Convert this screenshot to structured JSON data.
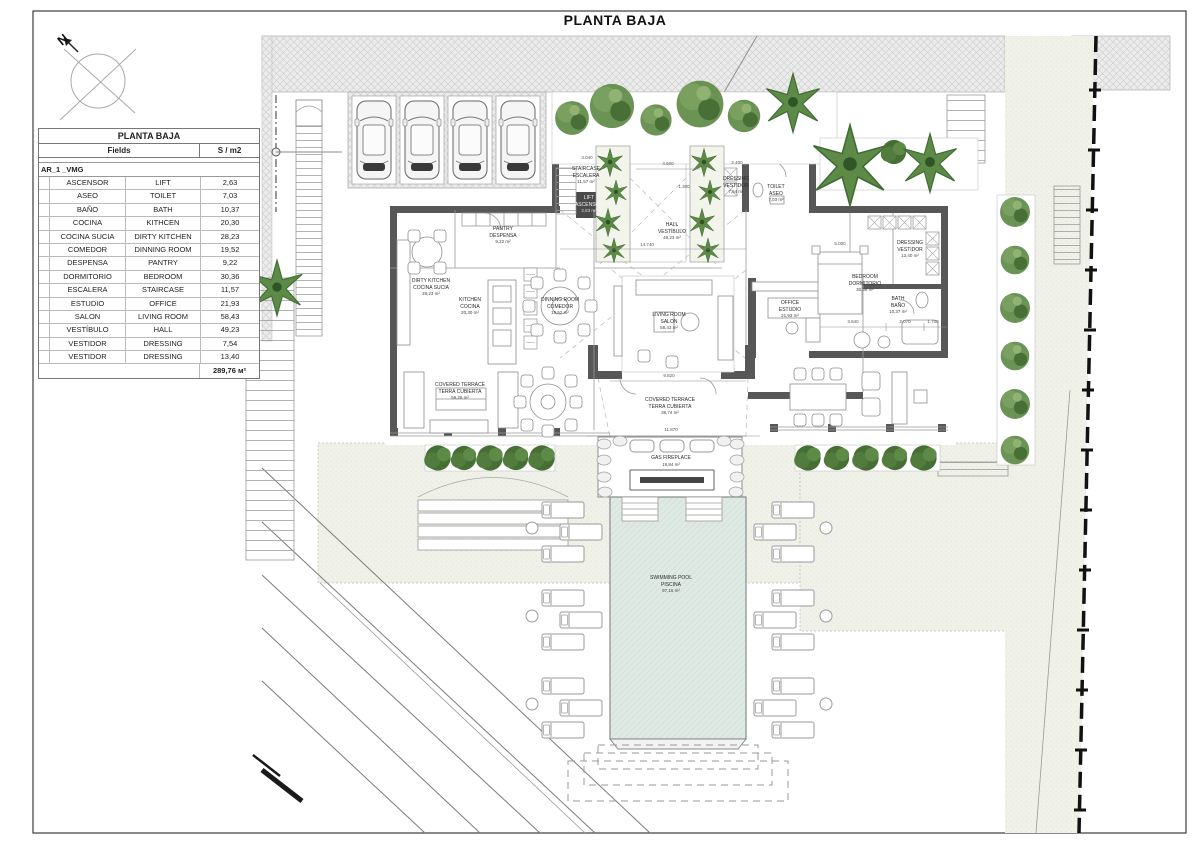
{
  "title": "PLANTA BAJA",
  "compass": {
    "north_label": "N"
  },
  "table": {
    "title": "PLANTA BAJA",
    "col_fields": "Fields",
    "col_area": "S / m2",
    "group": "AR_1 _VMG",
    "rows": [
      {
        "es": "ASCENSOR",
        "en": "LIFT",
        "area": "2,63"
      },
      {
        "es": "ASEO",
        "en": "TOILET",
        "area": "7,03"
      },
      {
        "es": "BAÑO",
        "en": "BATH",
        "area": "10,37"
      },
      {
        "es": "COCINA",
        "en": "KITHCEN",
        "area": "20,30"
      },
      {
        "es": "COCINA SUCIA",
        "en": "DIRTY KITCHEN",
        "area": "28,23"
      },
      {
        "es": "COMEDOR",
        "en": "DINNING ROOM",
        "area": "19,52"
      },
      {
        "es": "DESPENSA",
        "en": "PANTRY",
        "area": "9,22"
      },
      {
        "es": "DORMITORIO",
        "en": "BEDROOM",
        "area": "30,36"
      },
      {
        "es": "ESCALERA",
        "en": "STAIRCASE",
        "area": "11,57"
      },
      {
        "es": "ESTUDIO",
        "en": "OFFICE",
        "area": "21,93"
      },
      {
        "es": "SALON",
        "en": "LIVING ROOM",
        "area": "58,43"
      },
      {
        "es": "VESTÍBULO",
        "en": "HALL",
        "area": "49,23"
      },
      {
        "es": "VESTIDOR",
        "en": "DRESSING",
        "area": "7,54"
      },
      {
        "es": "VESTIDOR",
        "en": "DRESSING",
        "area": "13,40"
      }
    ],
    "total": "289,76 м²"
  },
  "plan": {
    "labels": {
      "pantry": {
        "en": "PANTRY",
        "es": "DESPENSA",
        "area": "9,22 m²"
      },
      "dirty_kitchen": {
        "en": "DIRTY KITCHEN",
        "es": "COCINA SUCIA",
        "area": "28,23 m²"
      },
      "kitchen": {
        "en": "KITCHEN",
        "es": "COCINA",
        "area": "20,30 m²"
      },
      "dining": {
        "en": "DINNING ROOM",
        "es": "COMEDOR",
        "area": "19,52 m²"
      },
      "living": {
        "en": "LIVING ROOM",
        "es": "SALON",
        "area": "58,43 m²"
      },
      "hall": {
        "en": "HALL",
        "es": "VESTÍBULO",
        "area": "49,23 m²"
      },
      "staircase": {
        "en": "STAIRCASE",
        "es": "ESCALERA",
        "area": "11,57 m²"
      },
      "lift": {
        "en": "LIFT",
        "es": "ASCENSOR",
        "area": "2,63 m²"
      },
      "dressing1": {
        "en": "DRESSING",
        "es": "VESTIDOR",
        "area": "7,54 m²"
      },
      "toilet": {
        "en": "TOILET",
        "es": "ASEO",
        "area": "7,03 m²"
      },
      "office": {
        "en": "OFFICE",
        "es": "ESTUDIO",
        "area": "21,93 m²"
      },
      "bedroom": {
        "en": "BEDROOM",
        "es": "DORMITORIO",
        "area": "30,36 m²"
      },
      "dressing2": {
        "en": "DRESSING",
        "es": "VESTIDOR",
        "area": "13,40 m²"
      },
      "bath": {
        "en": "BATH",
        "es": "BAÑO",
        "area": "10,37 m²"
      },
      "terrace_left": {
        "en": "COVERED TERRACE",
        "es": "TERRA CUBIERTA",
        "area": "59,26 m²"
      },
      "terrace_center": {
        "en": "COVERED TERRACE",
        "es": "TERRA CUBIERTA",
        "area": "38,74 m²"
      },
      "gas_fireplace": {
        "en": "GAS FIREPLACE",
        "es": "",
        "area": "19,84 m²"
      },
      "pool": {
        "en": "SWIMMING POOL",
        "es": "PISCINA",
        "area": "97,16 m²"
      }
    },
    "dims": [
      "4.040",
      "4.500",
      "1.300",
      "2.400",
      "5.000",
      "14.740",
      "9.820",
      "11.870",
      "3.640",
      "2.070",
      "1.700"
    ]
  },
  "colors": {
    "wall": "#575757",
    "line": "#8f8f8f",
    "green_dark": "#3f6b33",
    "green_mid": "#5d8a46",
    "green_light": "#8fae6e",
    "pool": "#e0eae4",
    "lawn": "#f0f1e8",
    "hatch": "#ececec"
  }
}
